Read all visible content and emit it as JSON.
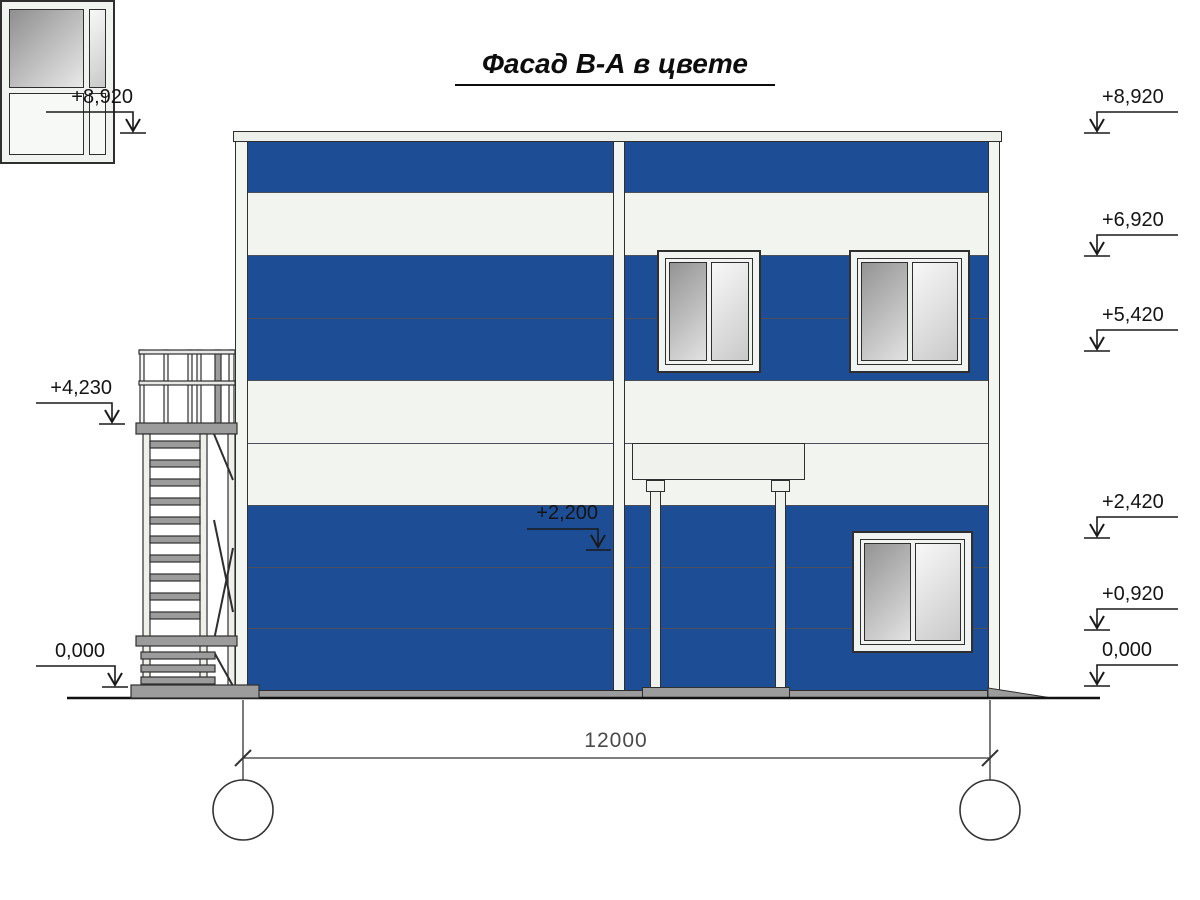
{
  "title": "Фасад В-А в цвете",
  "markers": {
    "left": [
      {
        "label": "+8,920"
      },
      {
        "label": "+4,230"
      },
      {
        "label": "0,000"
      }
    ],
    "right": [
      {
        "label": "+8,920"
      },
      {
        "label": "+6,920"
      },
      {
        "label": "+5,420"
      },
      {
        "label": "+2,420"
      },
      {
        "label": "+0,920"
      },
      {
        "label": "0,000"
      }
    ],
    "mid": [
      {
        "label": "+2,200"
      }
    ]
  },
  "dimension": {
    "value": "12000"
  },
  "axes": [
    {
      "label": "В"
    },
    {
      "label": "А"
    }
  ],
  "colors": {
    "facade_blue": "#1d4e95",
    "panel_white": "#f2f4f0",
    "trim_white": "#edefeb",
    "metal_gray": "#9c9c9c",
    "line_dark": "#2f2f2f",
    "dim_text_gray": "#4a4a4a"
  }
}
